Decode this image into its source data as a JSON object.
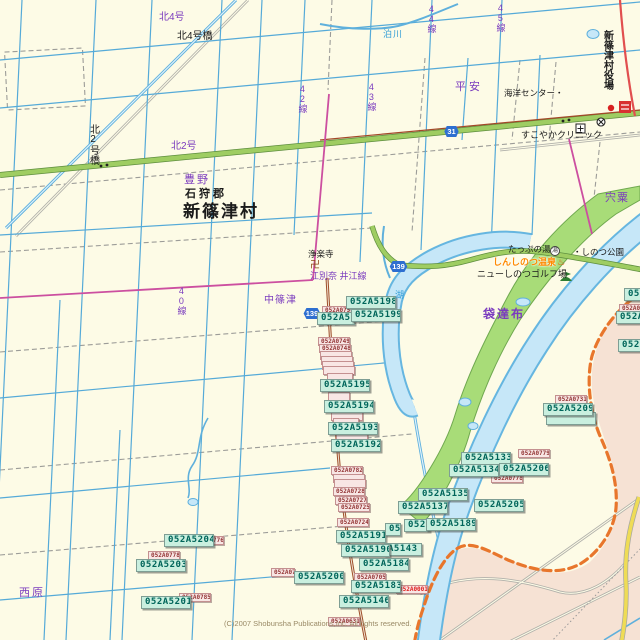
{
  "map": {
    "copyright": "(C)2007 Shobunsha Publications,Inc. All rights reserved.",
    "colors": {
      "background_cream": "#FDFBE6",
      "neighbor_area_pink": "#F6E2D4",
      "water_fill": "#C6E7F8",
      "water_edge": "#66B6E0",
      "green_route": "#9FCD62",
      "prefectural_magenta": "#CC4FA0",
      "boundary_orange": "#E8762C",
      "local_brown_road": "#9E4E2A",
      "yellow_road": "#EFDC55",
      "golf_green": "#A8DC78",
      "teal_label_bg": "#C9EFDF",
      "pink_label_bg": "#F8E6E4",
      "purple_text": "#7A3BBE",
      "shield_blue": "#2E6FD0"
    },
    "route_shields": [
      {
        "num": "139",
        "x": 302,
        "y": 308,
        "w": 20,
        "name": "route-shield-139-partial"
      },
      {
        "num": "31",
        "x": 443,
        "y": 126,
        "w": 17,
        "name": "route-shield-31"
      },
      {
        "num": "139",
        "x": 388,
        "y": 261,
        "w": 21,
        "name": "route-shield-139"
      }
    ],
    "place_labels": [
      {
        "text": "北4号",
        "x": 159,
        "y": 13,
        "cls": "pl-purple",
        "size": 10
      },
      {
        "text": "北4号橋",
        "x": 177,
        "y": 32,
        "cls": "pl-black",
        "size": 10
      },
      {
        "text": "北2号橋",
        "x": 87,
        "y": 124,
        "cls": "pl-black",
        "size": 10,
        "v": true
      },
      {
        "text": "北2号",
        "x": 171,
        "y": 142,
        "cls": "pl-purple",
        "size": 10
      },
      {
        "text": "豊野",
        "x": 184,
        "y": 175,
        "cls": "pl-purple",
        "size": 11,
        "ls": 2
      },
      {
        "text": "石狩郡",
        "x": 185,
        "y": 189,
        "cls": "pl-black",
        "size": 11,
        "b": true,
        "ls": 3
      },
      {
        "text": "新篠津村",
        "x": 183,
        "y": 203,
        "cls": "pl-black",
        "size": 17,
        "b": true,
        "ls": 2
      },
      {
        "text": "泊川",
        "x": 383,
        "y": 30,
        "cls": "pl-blue",
        "size": 9,
        "ls": 1
      },
      {
        "text": "42線",
        "x": 297,
        "y": 84,
        "cls": "pl-purple",
        "size": 9,
        "v": true
      },
      {
        "text": "43線",
        "x": 366,
        "y": 82,
        "cls": "pl-purple",
        "size": 9,
        "v": true
      },
      {
        "text": "44線",
        "x": 426,
        "y": 4,
        "cls": "pl-purple",
        "size": 9,
        "v": true
      },
      {
        "text": "45線",
        "x": 495,
        "y": 3,
        "cls": "pl-purple",
        "size": 9,
        "v": true
      },
      {
        "text": "40線",
        "x": 176,
        "y": 286,
        "cls": "pl-purple",
        "size": 9,
        "v": true
      },
      {
        "text": "平安",
        "x": 455,
        "y": 82,
        "cls": "pl-purple",
        "size": 11,
        "ls": 3
      },
      {
        "text": "海洋センター・",
        "x": 504,
        "y": 89,
        "cls": "pl-black",
        "size": 8.5
      },
      {
        "text": "新篠津村役場",
        "x": 601,
        "y": 30,
        "cls": "pl-black",
        "size": 10,
        "b": true,
        "v": true
      },
      {
        "text": "すこやかクリニック",
        "x": 521,
        "y": 131,
        "cls": "pl-black",
        "size": 9
      },
      {
        "text": "宍粟",
        "x": 605,
        "y": 193,
        "cls": "pl-purple",
        "size": 11,
        "ls": 1
      },
      {
        "text": "中篠津",
        "x": 264,
        "y": 296,
        "cls": "pl-purple",
        "size": 10,
        "ls": 1
      },
      {
        "text": "浄楽寺",
        "x": 308,
        "y": 250,
        "cls": "pl-black",
        "size": 8.5
      },
      {
        "text": "江別奈 井江線",
        "x": 310,
        "y": 272,
        "cls": "pl-purple",
        "size": 9
      },
      {
        "text": "湖",
        "x": 395,
        "y": 291,
        "cls": "pl-blue",
        "size": 9
      },
      {
        "text": "たっぷの湯",
        "x": 508,
        "y": 245,
        "cls": "pl-black",
        "size": 8.5
      },
      {
        "text": "・しのつ公園",
        "x": 573,
        "y": 248,
        "cls": "pl-black",
        "size": 8.5
      },
      {
        "text": "しんしのつ温泉",
        "x": 493,
        "y": 258,
        "cls": "pl-orange",
        "size": 9
      },
      {
        "text": "ニューしのつゴルフ場",
        "x": 477,
        "y": 270,
        "cls": "pl-black",
        "size": 9
      },
      {
        "text": "袋達布",
        "x": 483,
        "y": 308,
        "cls": "pl-purple",
        "size": 12,
        "b": true,
        "ls": 2
      },
      {
        "text": "西原",
        "x": 19,
        "y": 588,
        "cls": "pl-purple",
        "size": 11,
        "ls": 2
      }
    ],
    "glyph_icons": [
      {
        "name": "temple-manji-icon",
        "glyph": "卍",
        "x": 310,
        "y": 261,
        "color": "#8B4513",
        "size": 10
      },
      {
        "name": "day-spa-icon",
        "glyph": "湯",
        "x": 550,
        "y": 246,
        "color": "#333333",
        "size": 6,
        "circ": true
      },
      {
        "name": "hot-spring-icon",
        "glyph": "♨",
        "x": 557,
        "y": 258,
        "color": "#E84A00",
        "size": 9
      }
    ],
    "code_labels_pink": [
      {
        "text": "052A0751",
        "x": 322,
        "y": 306
      },
      {
        "text": "052A0749",
        "x": 318,
        "y": 337
      },
      {
        "text": "052A0748",
        "x": 319,
        "y": 344
      },
      {
        "text": "",
        "x": 320,
        "y": 351
      },
      {
        "text": "",
        "x": 321,
        "y": 356
      },
      {
        "text": "",
        "x": 322,
        "y": 361
      },
      {
        "text": "",
        "x": 323,
        "y": 366
      },
      {
        "text": "",
        "x": 327,
        "y": 373,
        "w": 26
      },
      {
        "text": "",
        "x": 328,
        "y": 392,
        "w": 22
      },
      {
        "text": "",
        "x": 331,
        "y": 412
      },
      {
        "text": "",
        "x": 333,
        "y": 418,
        "w": 26
      },
      {
        "text": "",
        "x": 336,
        "y": 433
      },
      {
        "text": "052A0782",
        "x": 331,
        "y": 466
      },
      {
        "text": "",
        "x": 333,
        "y": 474
      },
      {
        "text": "",
        "x": 334,
        "y": 479
      },
      {
        "text": "052A0728",
        "x": 333,
        "y": 487
      },
      {
        "text": "052A0727",
        "x": 335,
        "y": 496
      },
      {
        "text": "052A0725",
        "x": 338,
        "y": 503
      },
      {
        "text": "052A0724",
        "x": 337,
        "y": 518
      },
      {
        "text": "052A0705",
        "x": 354,
        "y": 573
      },
      {
        "text": "052A0001",
        "x": 396,
        "y": 585,
        "red": true
      },
      {
        "text": "052A0631",
        "x": 328,
        "y": 617
      },
      {
        "text": "052A0778",
        "x": 148,
        "y": 551
      },
      {
        "text": "052A0776",
        "x": 192,
        "y": 536
      },
      {
        "text": "052A0785",
        "x": 179,
        "y": 593
      },
      {
        "text": "052A0779",
        "x": 518,
        "y": 449
      },
      {
        "text": "052A0778",
        "x": 491,
        "y": 474
      },
      {
        "text": "052A0731",
        "x": 555,
        "y": 395
      },
      {
        "text": "052A07",
        "x": 619,
        "y": 304,
        "w": 26
      },
      {
        "text": "052A07",
        "x": 271,
        "y": 568,
        "w": 24
      }
    ],
    "code_labels_teal": [
      {
        "text": "052A5198",
        "x": 346,
        "y": 296
      },
      {
        "text": "052A51",
        "x": 317,
        "y": 312,
        "w": 38
      },
      {
        "text": "052A5199",
        "x": 351,
        "y": 309
      },
      {
        "text": "052A5195",
        "x": 320,
        "y": 379
      },
      {
        "text": "052A5194",
        "x": 324,
        "y": 400
      },
      {
        "text": "052A5193",
        "x": 328,
        "y": 422
      },
      {
        "text": "052A5192",
        "x": 331,
        "y": 439
      },
      {
        "text": "052A5191",
        "x": 336,
        "y": 530
      },
      {
        "text": "A5143",
        "x": 384,
        "y": 543,
        "w": 38
      },
      {
        "text": "052A5190",
        "x": 341,
        "y": 544,
        "w": 49
      },
      {
        "text": "052A5184",
        "x": 359,
        "y": 558
      },
      {
        "text": "052A5200",
        "x": 294,
        "y": 571
      },
      {
        "text": "052A5183",
        "x": 351,
        "y": 580
      },
      {
        "text": "052A5146",
        "x": 339,
        "y": 595
      },
      {
        "text": "052A5204",
        "x": 164,
        "y": 534
      },
      {
        "text": "052A5203",
        "x": 136,
        "y": 559
      },
      {
        "text": "052A5201",
        "x": 141,
        "y": 596
      },
      {
        "text": "",
        "x": 546,
        "y": 412,
        "w": 50
      },
      {
        "text": "052A5209",
        "x": 543,
        "y": 403
      },
      {
        "text": "052A5133",
        "x": 461,
        "y": 452
      },
      {
        "text": "052A5134",
        "x": 449,
        "y": 464
      },
      {
        "text": "052A5206",
        "x": 499,
        "y": 463
      },
      {
        "text": "052A5135",
        "x": 418,
        "y": 488
      },
      {
        "text": "052A5137",
        "x": 398,
        "y": 501
      },
      {
        "text": "052A5205",
        "x": 474,
        "y": 499
      },
      {
        "text": "05",
        "x": 385,
        "y": 523,
        "w": 16
      },
      {
        "text": "052A",
        "x": 404,
        "y": 519,
        "w": 26
      },
      {
        "text": "052A5189",
        "x": 426,
        "y": 518
      },
      {
        "text": "05",
        "x": 624,
        "y": 288,
        "w": 30
      },
      {
        "text": "052A5",
        "x": 616,
        "y": 311,
        "w": 36
      },
      {
        "text": "052",
        "x": 618,
        "y": 339,
        "w": 24
      }
    ]
  }
}
